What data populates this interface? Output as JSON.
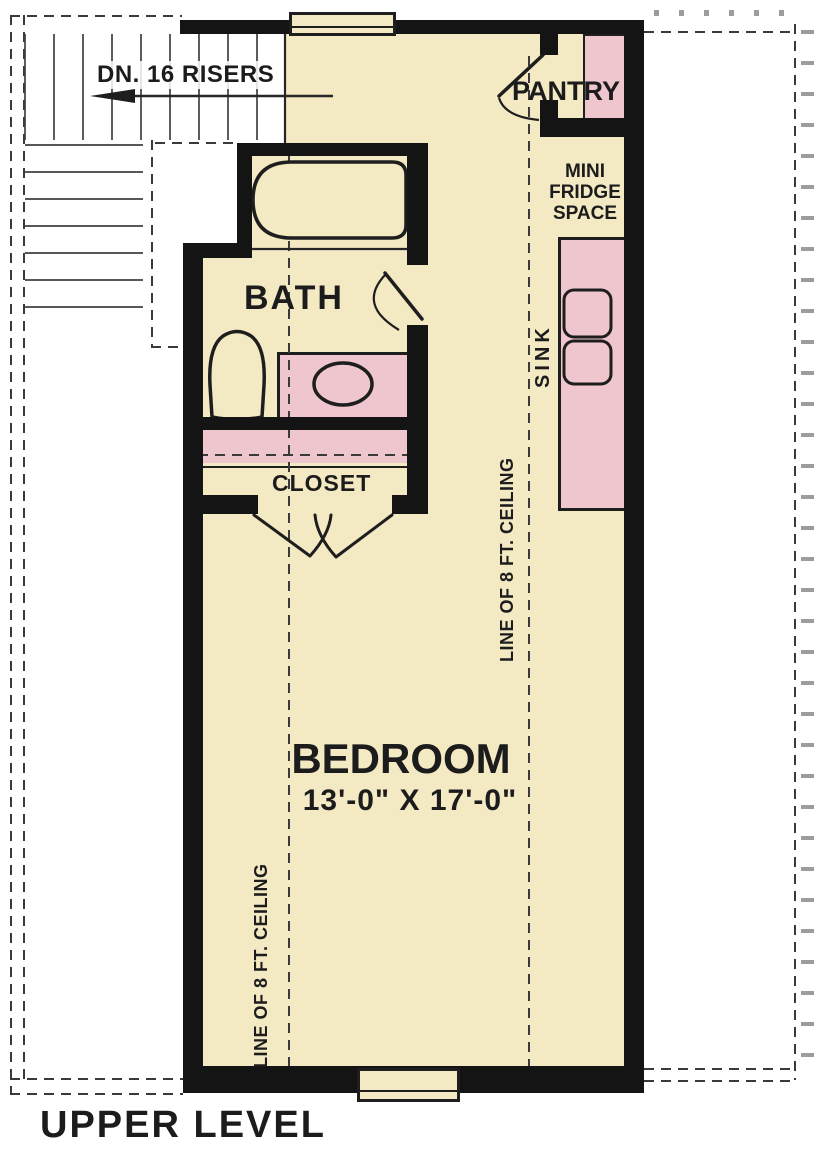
{
  "title": "UPPER LEVEL",
  "colors": {
    "paper": "#ffffff",
    "floor": "#f3e9c3",
    "fixture": "#f0c6ce",
    "wall": "#141414",
    "line": "#1e1e1e",
    "ink": "#1c1c1c",
    "dashc": "#3a3a3a",
    "tick": "#8a8a8a"
  },
  "stairs": {
    "note": "DN. 16 RISERS"
  },
  "rooms": {
    "pantry": {
      "name": "PANTRY"
    },
    "mini_fridge": {
      "line1": "MINI",
      "line2": "FRIDGE",
      "line3": "SPACE"
    },
    "sink": {
      "name": "SINK"
    },
    "bath": {
      "name": "BATH"
    },
    "closet": {
      "name": "CLOSET"
    },
    "bedroom": {
      "name": "BEDROOM",
      "dims": "13'-0\" X 17'-0\""
    }
  },
  "ceiling_note_left": "LINE OF 8 FT. CEILING",
  "ceiling_note_right": "LINE OF 8 FT. CEILING"
}
